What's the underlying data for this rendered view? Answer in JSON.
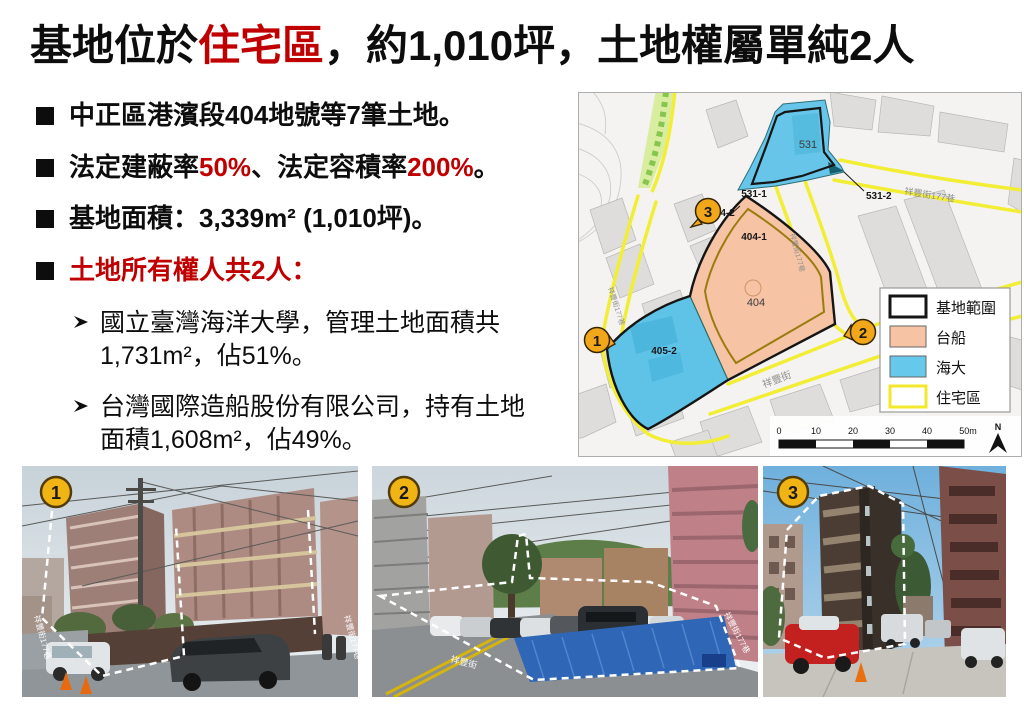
{
  "slide": {
    "title": {
      "pre": "基地位於",
      "highlight": "住宅區",
      "post": "，約1,010坪，土地權屬單純2人"
    },
    "bullet_marker": "black-square",
    "sub_marker": "arrowhead",
    "bullets": [
      {
        "segments": [
          {
            "t": "中正區港濱段404地號等7筆土地。",
            "c": "k"
          }
        ]
      },
      {
        "segments": [
          {
            "t": "法定建蔽率",
            "c": "k"
          },
          {
            "t": "50%",
            "c": "r"
          },
          {
            "t": "、法定容積率",
            "c": "k"
          },
          {
            "t": "200%",
            "c": "r"
          },
          {
            "t": "。",
            "c": "k"
          }
        ]
      },
      {
        "segments": [
          {
            "t": "基地面積：3,339m² (1,010坪)。",
            "c": "k"
          }
        ]
      },
      {
        "segments": [
          {
            "t": "土地所有權人共2人：",
            "c": "r"
          }
        ]
      }
    ],
    "sub_bullets": [
      {
        "lines": [
          "國立臺灣海洋大學，管理土地面積共",
          "1,731m²，佔51%。"
        ]
      },
      {
        "lines": [
          "台灣國際造船股份有限公司，持有土地",
          "面積1,608m²，佔49%。"
        ]
      }
    ],
    "accent_color": "#C00000"
  },
  "map": {
    "parcels": {
      "p531": "531",
      "p531_1": "531-1",
      "p531_2": "531-2",
      "p404_2": "404-2",
      "p404_1": "404-1",
      "p404": "404",
      "p405_2": "405-2"
    },
    "streets": {
      "left": "祥豐街177巷",
      "middle": "祥豐街177巷",
      "top_right": "祥豐街177巷",
      "bottom": "祥豐街"
    },
    "markers": [
      "1",
      "2",
      "3"
    ],
    "legend": [
      {
        "label": "基地範圍",
        "swatch": "site-boundary"
      },
      {
        "label": "台船",
        "swatch": "csbc-orange"
      },
      {
        "label": "海大",
        "swatch": "ntou-blue"
      },
      {
        "label": "住宅區",
        "swatch": "residential-yellow"
      }
    ],
    "scale": {
      "ticks": [
        "0",
        "10",
        "20",
        "30",
        "40",
        "50m"
      ],
      "north": "N"
    },
    "colors": {
      "csbc": "#F6C3A4",
      "ntou": "#5FC3E8",
      "residential_line": "#F2EE35",
      "site_line": "#151515",
      "marker": "#F2A71B"
    }
  },
  "photos": [
    {
      "number": "1",
      "labels": [
        {
          "text": "祥豐街177巷",
          "pos": "left-edge"
        },
        {
          "text": "祥豐街177巷",
          "pos": "right-edge"
        }
      ]
    },
    {
      "number": "2",
      "labels": [
        {
          "text": "祥豐街",
          "pos": "road"
        },
        {
          "text": "祥豐街177巷",
          "pos": "right-edge"
        }
      ]
    },
    {
      "number": "3",
      "labels": []
    }
  ]
}
